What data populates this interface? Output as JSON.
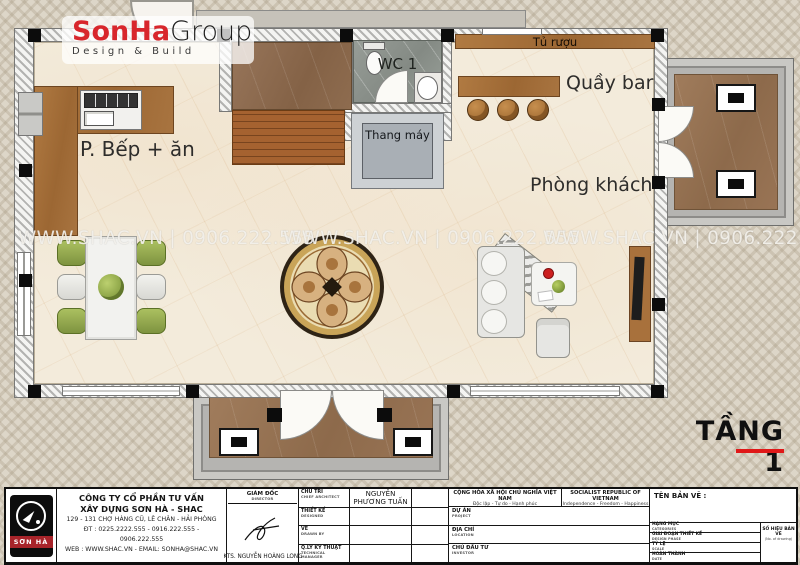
{
  "logo": {
    "brand_primary": "SonHa",
    "brand_secondary": "Group",
    "tagline": "Design & Build"
  },
  "watermark_text": "WWW.SHAC.VN  |  0906.222.555",
  "rooms": {
    "kitchen": "P. Bếp + ăn",
    "wc": "WC 1",
    "elevator": "Thang máy",
    "wine_cabinet": "Tủ rượu",
    "bar": "Quầy bar",
    "living": "Phòng khách"
  },
  "floor_label": "TẦNG 1",
  "colors": {
    "accent_red": "#e01818",
    "brand_red": "#d8262c",
    "wood_brown": "#a9743e",
    "floor_cream": "#f3ebdb",
    "porch_gray": "#b5b4b1"
  },
  "title_block": {
    "logo_text": "SƠN HÀ",
    "company_line1": "CÔNG TY CỔ PHẦN TƯ VẤN",
    "company_line2": "XÂY DỰNG SƠN HÀ - SHAC",
    "address": "129 - 131 CHỢ HÀNG CŨ, LÊ CHÂN - HẢI PHÒNG",
    "phone": "ĐT : 0225.2222.555 - 0916.222.555 - 0906.222.555",
    "web": "WEB : WWW.SHAC.VN - EMAIL: SONHA@SHAC.VN",
    "director_label": "GIÁM ĐỐC",
    "director_label_en": "DIRECTOR",
    "director_name": "KTS. NGUYỄN HOÀNG LONG",
    "rows": [
      {
        "label": "CHỦ TRÌ",
        "label_en": "CHIEF ARCHITECT",
        "value": "NGUYỄN PHƯƠNG TUẤN"
      },
      {
        "label": "THIẾT KẾ",
        "label_en": "DESIGNED",
        "value": ""
      },
      {
        "label": "VẼ",
        "label_en": "DRAWN BY",
        "value": ""
      },
      {
        "label": "Q.LÝ KỸ THUẬT",
        "label_en": "TECHNICAL MANAGER",
        "value": ""
      }
    ],
    "national_header": {
      "vi": "CỘNG HÒA XÃ HỘI CHỦ NGHĨA VIỆT NAM",
      "vi_sub": "Độc lập - Tự do - Hạnh phúc",
      "en": "SOCIALIST REPUBLIC OF VIETNAM",
      "en_sub": "Independence - Freedom - Happiness"
    },
    "project_rows": [
      {
        "label": "DỰ ÁN",
        "label_en": "PROJECT"
      },
      {
        "label": "ĐỊA CHỈ",
        "label_en": "LOCATION"
      },
      {
        "label": "CHỦ ĐẦU TƯ",
        "label_en": "INVESTOR"
      }
    ],
    "drawing_name_label": "TÊN BẢN VẼ :",
    "right_rows": [
      {
        "label": "HẠNG MỤC",
        "label_en": "CATEGORIES"
      },
      {
        "label": "GIAI ĐOẠN THIẾT KẾ",
        "label_en": "DESIGN PHASE"
      },
      {
        "label": "TỶ LỆ",
        "label_en": "SCALE"
      },
      {
        "label": "HOÀN THÀNH",
        "label_en": "DATE"
      }
    ],
    "drawing_no_label": "SỐ HIỆU BẢN VẼ",
    "drawing_no_sub": "(No. of drawing)"
  }
}
